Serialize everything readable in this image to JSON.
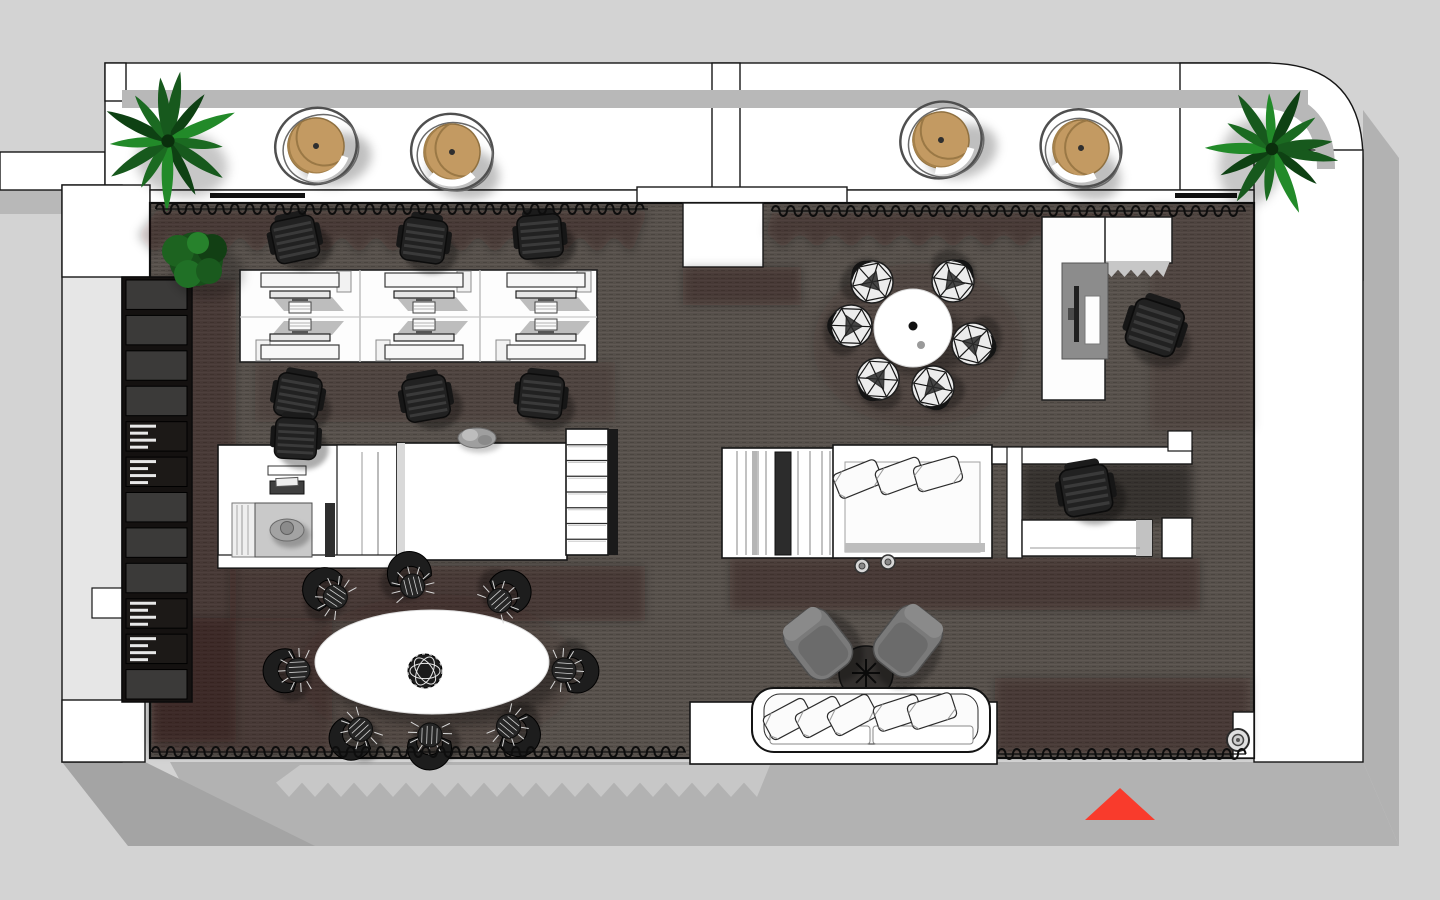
{
  "meta": {
    "scene": "office-floor-plan-top-view",
    "style": "3d-rendered-architectural-plan",
    "background": "#d3d3d3"
  },
  "palette": {
    "carpet": "#57514c",
    "carpet_line_light": "#605a54",
    "carpet_line_dark": "#4a443f",
    "wall": "#ffffff",
    "outline": "#141414",
    "plan_shadow": "#b2b2b2",
    "balcony_band": "#b8b8b8",
    "plant_dark": "#0d3e12",
    "plant_mid": "#1e6f24",
    "rattan": "#c39a62",
    "chair_dark": "#212121",
    "lounge_gray": "#7a7a7a",
    "marker_red": "#f93b2c"
  },
  "balcony": {
    "palms": [
      {
        "x": 168,
        "y": 141,
        "s": 1.1,
        "r": 10
      },
      {
        "x": 1272,
        "y": 149,
        "s": 1.05,
        "r": 100
      }
    ],
    "rattan_chairs": [
      {
        "x": 316,
        "y": 146,
        "r": -15
      },
      {
        "x": 452,
        "y": 152,
        "r": 12
      },
      {
        "x": 941,
        "y": 140,
        "r": -20
      },
      {
        "x": 1081,
        "y": 148,
        "r": 28
      }
    ]
  },
  "planters": {
    "bushes": [
      {
        "x": 196,
        "y": 259,
        "s": 1
      }
    ]
  },
  "workspace": {
    "desk": {
      "x": 240,
      "y": 270,
      "w": 357,
      "h": 92,
      "cols": 3,
      "rows": 2
    },
    "workstations": [
      {
        "x": 300,
        "y": 294,
        "flip": false
      },
      {
        "x": 424,
        "y": 294,
        "flip": false
      },
      {
        "x": 546,
        "y": 294,
        "flip": false
      },
      {
        "x": 300,
        "y": 338,
        "flip": true
      },
      {
        "x": 424,
        "y": 338,
        "flip": true
      },
      {
        "x": 546,
        "y": 338,
        "flip": true
      }
    ],
    "desk_tabs": [
      {
        "x": 337,
        "y": 271
      },
      {
        "x": 457,
        "y": 271
      },
      {
        "x": 577,
        "y": 271
      },
      {
        "x": 256,
        "y": 340
      },
      {
        "x": 376,
        "y": 340
      },
      {
        "x": 496,
        "y": 340
      }
    ],
    "task_chairs": [
      {
        "x": 295,
        "y": 239,
        "r": -12,
        "s": 1
      },
      {
        "x": 424,
        "y": 240,
        "r": 8,
        "s": 1
      },
      {
        "x": 540,
        "y": 236,
        "r": -5,
        "s": 1
      },
      {
        "x": 298,
        "y": 396,
        "r": 10,
        "s": 1
      },
      {
        "x": 426,
        "y": 398,
        "r": -10,
        "s": 1
      },
      {
        "x": 541,
        "y": 396,
        "r": 6,
        "s": 1
      },
      {
        "x": 296,
        "y": 438,
        "r": 3,
        "s": 0.95
      },
      {
        "x": 1155,
        "y": 327,
        "r": 18,
        "s": 1.15
      },
      {
        "x": 1086,
        "y": 490,
        "r": -10,
        "s": 1.1
      }
    ]
  },
  "round_table": {
    "cx": 913,
    "cy": 328,
    "r": 39,
    "chairs": [
      {
        "x": 973,
        "y": 344,
        "r": 285
      },
      {
        "x": 933,
        "y": 387,
        "r": 341
      },
      {
        "x": 878,
        "y": 379,
        "r": 34
      },
      {
        "x": 851,
        "y": 326,
        "r": 92
      },
      {
        "x": 872,
        "y": 282,
        "r": 138
      },
      {
        "x": 953,
        "y": 281,
        "r": 220
      }
    ]
  },
  "oval_table": {
    "cx": 432,
    "cy": 662,
    "rx": 117,
    "ry": 52,
    "centerpiece": {
      "x": 425,
      "y": 671,
      "r": 17
    },
    "chairs": [
      {
        "x": 337,
        "y": 598,
        "r": 124
      },
      {
        "x": 413,
        "y": 588,
        "r": 166
      },
      {
        "x": 498,
        "y": 602,
        "r": 228
      },
      {
        "x": 300,
        "y": 670,
        "r": 87
      },
      {
        "x": 562,
        "y": 670,
        "r": 274
      },
      {
        "x": 362,
        "y": 728,
        "r": 47
      },
      {
        "x": 430,
        "y": 733,
        "r": 2
      },
      {
        "x": 507,
        "y": 725,
        "r": 310
      }
    ]
  },
  "lounge": {
    "chairs": [
      {
        "x": 818,
        "y": 644,
        "r": -38
      },
      {
        "x": 908,
        "y": 641,
        "r": 38
      }
    ],
    "coffee_table": {
      "x": 866,
      "y": 673,
      "r": 27
    },
    "sofa_pillows": [
      {
        "x": 788,
        "y": 719,
        "r": -28
      },
      {
        "x": 820,
        "y": 717,
        "r": -28
      },
      {
        "x": 852,
        "y": 715,
        "r": -28
      },
      {
        "x": 898,
        "y": 713,
        "r": -18
      },
      {
        "x": 932,
        "y": 711,
        "r": -18
      }
    ]
  },
  "bed": {
    "pillows": [
      {
        "x": 858,
        "y": 479,
        "r": -22
      },
      {
        "x": 900,
        "y": 476,
        "r": -20
      },
      {
        "x": 938,
        "y": 474,
        "r": -16
      }
    ],
    "knobs": [
      {
        "x": 862,
        "y": 566
      },
      {
        "x": 888,
        "y": 562
      }
    ]
  },
  "bookshelf": {
    "x": 122,
    "y": 277,
    "w": 70,
    "h": 425,
    "cells": 12,
    "book_rows": [
      4,
      5,
      9,
      10
    ]
  },
  "stairs": {
    "x": 566,
    "y": 429,
    "w": 42,
    "h": 126,
    "treads": 8
  },
  "occupants": {
    "person": {
      "x": 287,
      "y": 530
    },
    "sculpture": {
      "x": 477,
      "y": 438
    }
  },
  "curtains": [
    {
      "x1": 156,
      "x2": 648,
      "y": 209
    },
    {
      "x1": 772,
      "x2": 1246,
      "y": 211
    },
    {
      "x1": 152,
      "x2": 686,
      "y": 752
    },
    {
      "x1": 998,
      "x2": 1246,
      "y": 754
    }
  ],
  "curtain_shadows": [
    {
      "x1": 156,
      "x2": 648,
      "y": 211,
      "depth": 44
    },
    {
      "x1": 772,
      "x2": 1140,
      "y": 213,
      "depth": 36
    }
  ],
  "door_pivot": {
    "x": 1238,
    "y": 740
  },
  "marker": {
    "points": "1085,820 1155,820 1120,788",
    "color": "#f93b2c"
  }
}
